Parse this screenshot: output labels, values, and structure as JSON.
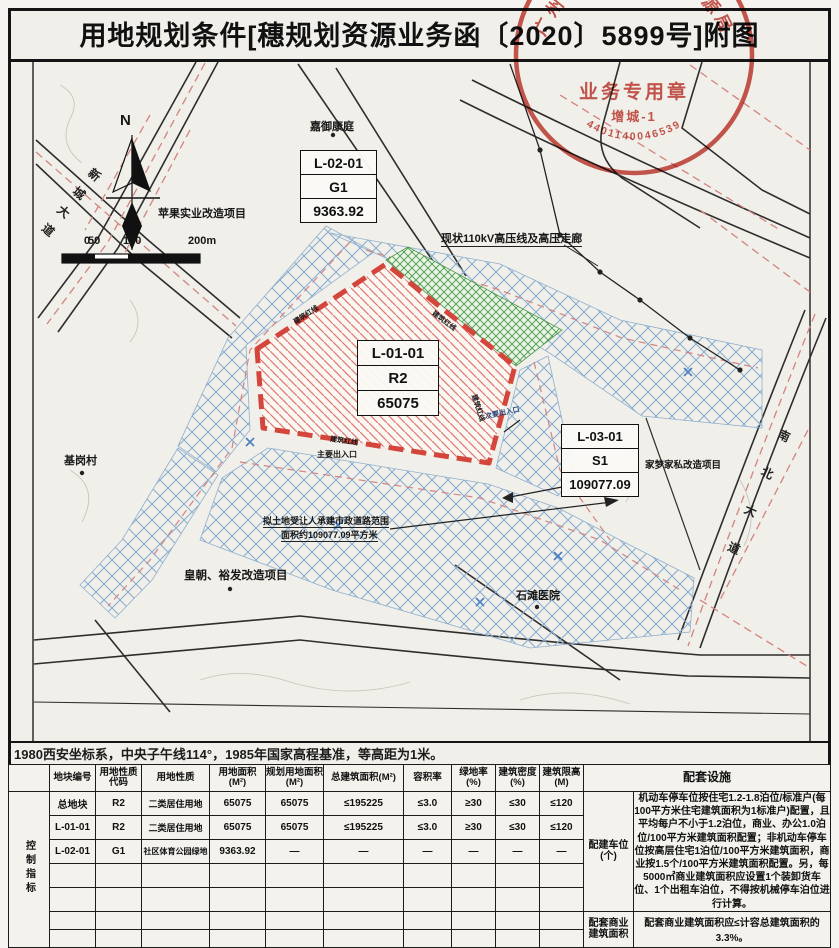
{
  "title": "用地规划条件[穗规划资源业务函〔2020〕5899号]附图",
  "stamp": {
    "org": "广州市规划和自然资源局",
    "center_line": "业务专用章",
    "sub_line": "增城-1",
    "number": "4401140046539"
  },
  "map": {
    "north_label": "N",
    "scale": {
      "t0": "0",
      "t50": "50",
      "t100": "100",
      "t200": "200m"
    },
    "roads": {
      "xincheng": "新城大道",
      "nanbei": "南北大道"
    },
    "places": {
      "jiayu": "嘉御康庭",
      "pingguo": "苹果实业改造项目",
      "jigang": "基岗村",
      "huangchao": "皇朝、裕发改造项目",
      "shitan": "石滩医院",
      "jiameng": "家梦家私改造项目"
    },
    "power_line": "现状110kV高压线及高压走廊",
    "red_line_label": "建筑红线",
    "entrance_main": "主要出入口",
    "entrance_secondary": "次要出入口",
    "road_note_line1": "拟土地受让人承建市政道路范围",
    "road_note_line2": "面积约109077.09平方米",
    "parcels": {
      "l0201": {
        "code": "L-02-01",
        "use": "G1",
        "area": "9363.92"
      },
      "l0101": {
        "code": "L-01-01",
        "use": "R2",
        "area": "65075"
      },
      "l0301": {
        "code": "L-03-01",
        "use": "S1",
        "area": "109077.09"
      }
    }
  },
  "note": "1980西安坐标系，中央子午线114°，1985年国家高程基准，等高距为1米。",
  "table": {
    "left_header": "控制指标",
    "headers": [
      "地块编号",
      "用地性质代码",
      "用地性质",
      "用地面积(M²)",
      "规划用地面积(M²)",
      "总建筑面积(M²)",
      "容积率",
      "绿地率(%)",
      "建筑密度(%)",
      "建筑限高(M)",
      "配套设施"
    ],
    "rows": [
      [
        "总地块",
        "R2",
        "二类居住用地",
        "65075",
        "65075",
        "≤195225",
        "≤3.0",
        "≥30",
        "≤30",
        "≤120"
      ],
      [
        "L-01-01",
        "R2",
        "二类居住用地",
        "65075",
        "65075",
        "≤195225",
        "≤3.0",
        "≥30",
        "≤30",
        "≤120"
      ],
      [
        "L-02-01",
        "G1",
        "社区体育公园绿地",
        "9363.92",
        "—",
        "—",
        "—",
        "—",
        "—",
        "—"
      ]
    ],
    "facilities": {
      "parking_label": "配建车位(个)",
      "parking_text": "机动车停车位按住宅1.2-1.8泊位/标准户(每100平方米住宅建筑面积为1标准户)配置，且平均每户不小于1.2泊位，商业、办公1.0泊位/100平方米建筑面积配置；非机动车停车位按高层住宅1泊位/100平方米建筑面积，商业按1.5个/100平方米建筑面积配置。另，每5000㎡商业建筑面积应设置1个装卸货车位、1个出租车泊位，不得按机械停车泊位进行计算。",
      "commercial_label": "配套商业建筑面积",
      "commercial_text": "配套商业建筑面积应≤计容总建筑面积的3.3%。"
    }
  }
}
